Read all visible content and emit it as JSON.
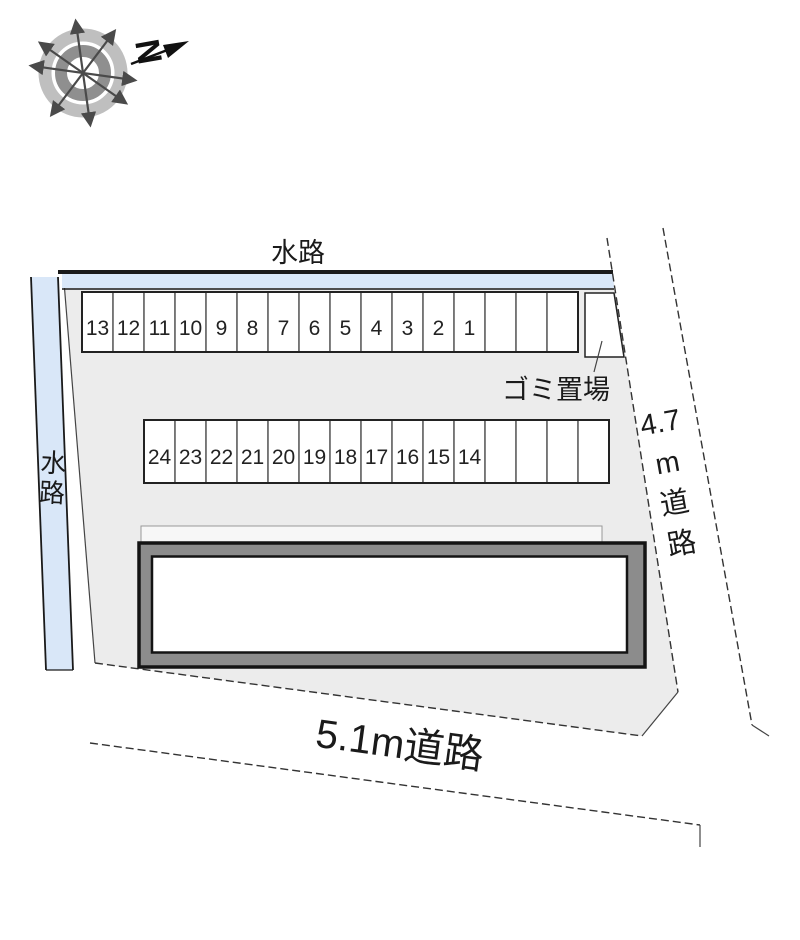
{
  "compass": {
    "north_label": "N"
  },
  "labels": {
    "waterway_top": "水路",
    "waterway_left": "水路",
    "garbage": "ゴミ置場",
    "road_right": "4.7m道路",
    "road_bottom": "5.1m道路"
  },
  "parking": {
    "row_top": {
      "numbers": [
        "13",
        "12",
        "11",
        "10",
        "9",
        "8",
        "7",
        "6",
        "5",
        "4",
        "3",
        "2",
        "1",
        "",
        "",
        ""
      ]
    },
    "row_middle": {
      "numbers": [
        "24",
        "23",
        "22",
        "21",
        "20",
        "19",
        "18",
        "17",
        "16",
        "15",
        "14",
        "",
        "",
        "",
        ""
      ]
    }
  },
  "colors": {
    "waterway_fill": "#d9e7f8",
    "site_fill": "#ececec",
    "building_band": "#8c8c8c",
    "outline": "#1a1a1a",
    "compass_ring_outer": "#bfbfbf",
    "compass_ring_inner": "#8f8f8f",
    "compass_arrow": "#4a4a4a"
  }
}
